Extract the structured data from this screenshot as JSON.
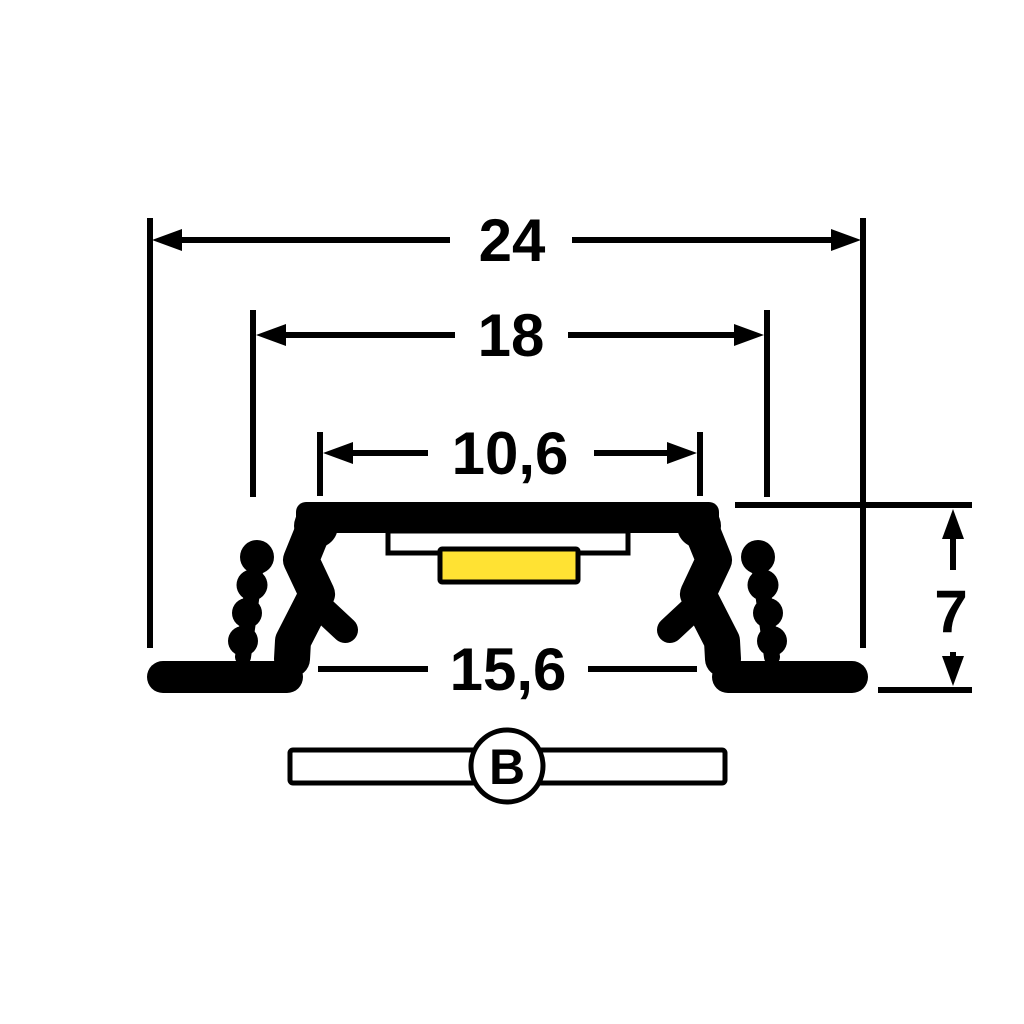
{
  "diagram": {
    "type": "technical-cross-section-drawing",
    "subject": "recessed LED aluminium profile with spring mounting clips",
    "dimensions": {
      "overall_width": "24",
      "top_width": "18",
      "opening_width": "10,6",
      "base_width": "15,6",
      "height": "7"
    },
    "section_marker": "B",
    "colors": {
      "line": "#000000",
      "background": "#FFFFFF",
      "led_strip": "#FFE233"
    }
  }
}
